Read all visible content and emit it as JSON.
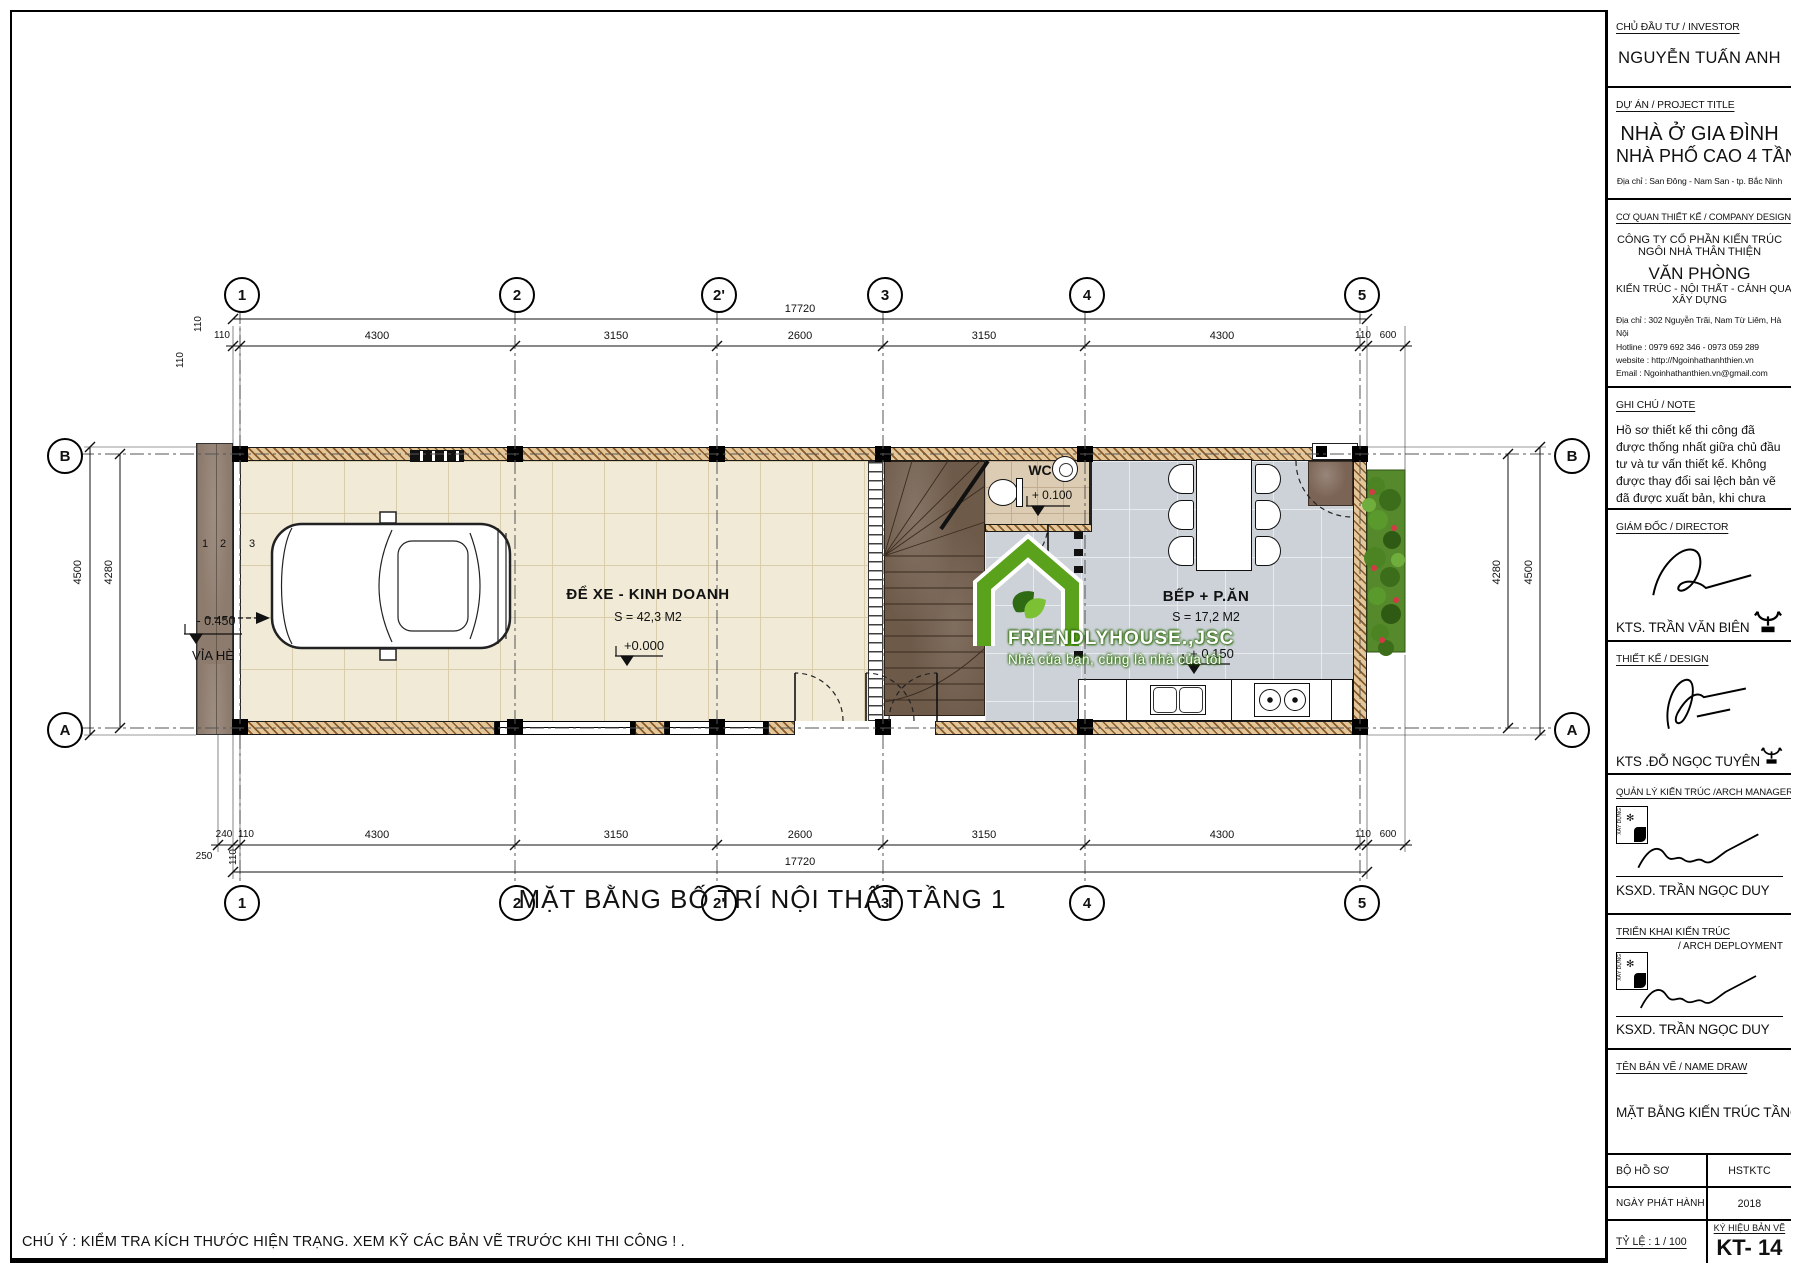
{
  "plan": {
    "title": "MẶT BẰNG BỐ TRÍ NỘI THẤT TẦNG 1",
    "note": "CHÚ Ý : KIỂM TRA KÍCH THƯỚC HIỆN TRẠNG. XEM KỸ CÁC BẢN VẼ TRƯỚC KHI THI CÔNG ! .",
    "grid_cols": [
      "1",
      "2",
      "2'",
      "3",
      "4",
      "5"
    ],
    "grid_rows": [
      "B",
      "A"
    ],
    "dims": {
      "total": "17720",
      "top": [
        "110",
        "4300",
        "3150",
        "2600",
        "3150",
        "4300",
        "110",
        "600"
      ],
      "bottom": [
        "240",
        "110",
        "4300",
        "3150",
        "2600",
        "3150",
        "4300",
        "110",
        "600"
      ],
      "bottom_extra": [
        "250",
        "110"
      ],
      "left": [
        "4500",
        "4280"
      ],
      "right": [
        "4280",
        "4500"
      ],
      "wall": "110"
    },
    "rooms": {
      "garage": {
        "name": "ĐỂ XE - KINH DOANH",
        "area": "S = 42,3 M2",
        "level": "+0.000"
      },
      "kitchen": {
        "name": "BẾP + P.ĂN",
        "area": "S = 17,2 M2",
        "level": "+ 0.150"
      },
      "wc": {
        "name": "WC",
        "level": "+ 0.100"
      },
      "sidewalk": {
        "name": "VỈA HÈ",
        "level": "- 0.450"
      }
    },
    "steps": [
      "1",
      "2",
      "3"
    ],
    "logo": {
      "name": "FRIENDLYHOUSE.,JSC",
      "tagline": "Nhà của bạn, cũng là nhà của tôi"
    }
  },
  "title_block": {
    "stamp_text": "XÂY DỰNG",
    "investor": {
      "heading": "CHỦ ĐẦU TƯ / INVESTOR",
      "name": "NGUYỄN TUẤN ANH"
    },
    "project": {
      "heading": "DỰ ÁN / PROJECT TITLE",
      "line1": "NHÀ Ở GIA ĐÌNH",
      "line2": "NHÀ PHỐ CAO 4 TẦNG",
      "address": "Địa chỉ : San Đông - Nam San - tp. Bắc Ninh"
    },
    "company": {
      "heading": "CƠ QUAN THIẾT KẾ / COMPANY DESIGN",
      "line1": "CÔNG TY CỔ PHẦN KIẾN TRÚC",
      "line2": "NGÔI NHÀ THÂN THIỆN",
      "office": "VĂN PHÒNG",
      "fields1": "KIẾN TRÚC - NỘI THẤT - CẢNH QUAN",
      "fields2": "XÂY DỰNG",
      "address": "Địa chỉ : 302 Nguyễn Trãi, Nam Từ Liêm, Hà Nội",
      "hotline": "Hotline : 0979 692 346 - 0973 059 289",
      "website": "website : http://Ngoinhathanhthien.vn",
      "email": "Email : Ngoinhathanthien.vn@gmail.com"
    },
    "note": {
      "heading": "GHI CHÚ / NOTE",
      "text": "Hồ sơ thiết kế thi công đã được thống nhất giữa chủ đầu tư và tư vấn thiết kế. Không được thay đổi sai lệch bản vẽ đã được xuất bản, khi chưa được phép của tư vấn thiết kế ! ."
    },
    "director": {
      "heading": "GIÁM ĐỐC / DIRECTOR",
      "name": "KTS. TRẦN VĂN BIÊN"
    },
    "design": {
      "heading": "THIẾT KẾ / DESIGN",
      "name": "KTS .ĐỖ NGỌC TUYÊN"
    },
    "manager": {
      "heading": "QUẢN LÝ KIẾN TRÚC /ARCH MANAGER",
      "name": "KSXD. TRẦN NGỌC DUY"
    },
    "deployment": {
      "heading": "TRIỂN KHAI KIẾN TRÚC",
      "heading2": "/ ARCH DEPLOYMENT",
      "name": "KSXD. TRẦN NGỌC DUY"
    },
    "drawing": {
      "heading": "TÊN BẢN VẼ / NAME DRAW",
      "name": "MẶT BẰNG KIẾN TRÚC TẦNG1"
    },
    "info": {
      "dossier_label": "BỘ HỒ SƠ",
      "dossier_value": "HSTKTC",
      "date_label": "NGÀY PHÁT HÀNH",
      "date_value": "2018",
      "scale_label": "TỶ LỆ : 1 / 100",
      "symbol_label": "KÝ HIỆU BẢN VẼ",
      "symbol_value": "KT- 14"
    }
  }
}
